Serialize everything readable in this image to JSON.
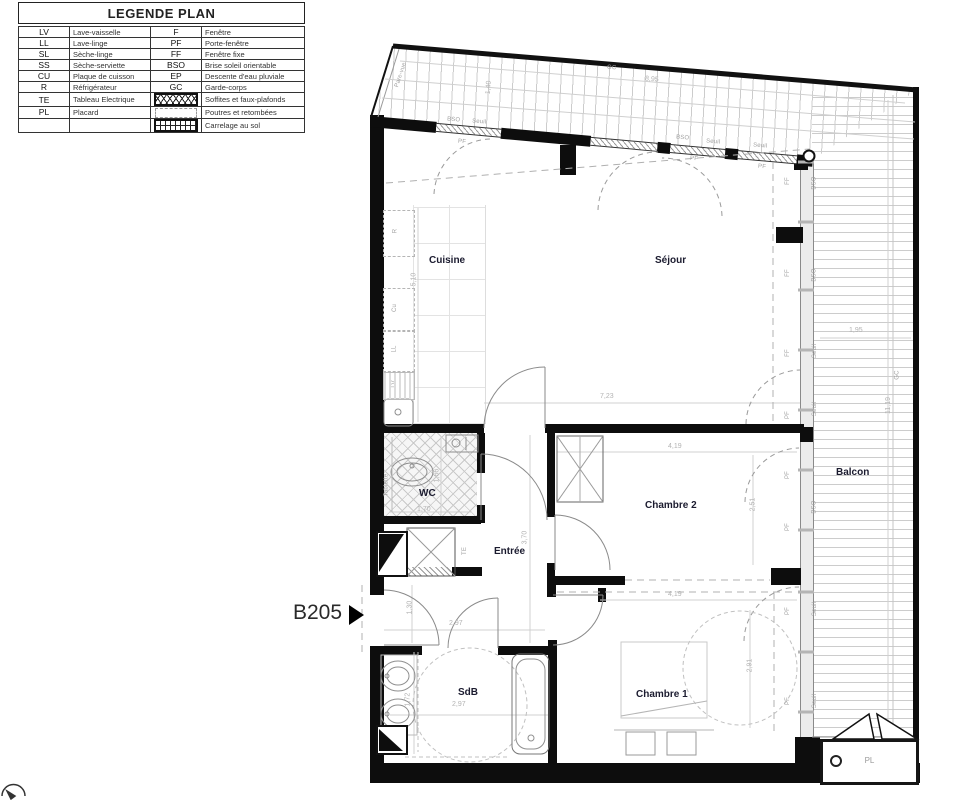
{
  "legend": {
    "title": "LEGENDE PLAN",
    "left": [
      {
        "code": "LV",
        "label": "Lave-vaisselle"
      },
      {
        "code": "LL",
        "label": "Lave-linge"
      },
      {
        "code": "SL",
        "label": "Sèche-linge"
      },
      {
        "code": "SS",
        "label": "Sèche-serviette"
      },
      {
        "code": "CU",
        "label": "Plaque de cuisson"
      },
      {
        "code": "R",
        "label": "Réfrigérateur"
      },
      {
        "code": "TE",
        "label": "Tableau Electrique"
      },
      {
        "code": "PL",
        "label": "Placard"
      },
      {
        "code": "",
        "label": ""
      }
    ],
    "right": [
      {
        "code": "F",
        "label": "Fenêtre"
      },
      {
        "code": "PF",
        "label": "Porte-fenêtre"
      },
      {
        "code": "FF",
        "label": "Fenêtre fixe"
      },
      {
        "code": "BSO",
        "label": "Brise soleil orientable"
      },
      {
        "code": "EP",
        "label": "Descente d'eau pluviale"
      },
      {
        "code": "GC",
        "label": "Garde-corps"
      },
      {
        "code": "",
        "icon": "crosshatch-swatch",
        "label": "Soffites et faux-plafonds"
      },
      {
        "code": "",
        "icon": "dashed-box-swatch",
        "label": "Poutres et retombées"
      },
      {
        "code": "",
        "icon": "tile-grid-swatch",
        "label": "Carrelage au sol"
      }
    ]
  },
  "unit": {
    "label": "B205"
  },
  "rooms": {
    "cuisine": "Cuisine",
    "sejour": "Séjour",
    "wc": "WC",
    "entree": "Entrée",
    "chambre2": "Chambre 2",
    "chambre1": "Chambre 1",
    "sdb": "SdB",
    "balcon": "Balcon",
    "placard": "PL"
  },
  "dims": {
    "terrace_w": "8,95",
    "terrace_d": "1,40",
    "kitchen_h": "5,10",
    "sejour_w": "7,23",
    "balcon_w": "1,95",
    "balcon_h": "11,19",
    "wc_h": "1,66",
    "wc_w": "1,70",
    "entree_h": "3,70",
    "entree_w": "2,97",
    "entree_door": "1,30",
    "ch2_w": "4,19",
    "ch2_h": "2,51",
    "ch1_w": "4,19",
    "ch1_h": "2,91",
    "sdb_w": "2,97",
    "sdb_h": "1,72"
  },
  "annotations": {
    "gc": "GC",
    "pare_vue": "Pare-vue",
    "bso": "BSO",
    "seuil": "Seuil",
    "pf": "PF",
    "ff": "FF",
    "te": "TE",
    "tablette": "Tablette",
    "r": "R",
    "cu": "Cu",
    "ll": "LL",
    "lv": "LV"
  }
}
